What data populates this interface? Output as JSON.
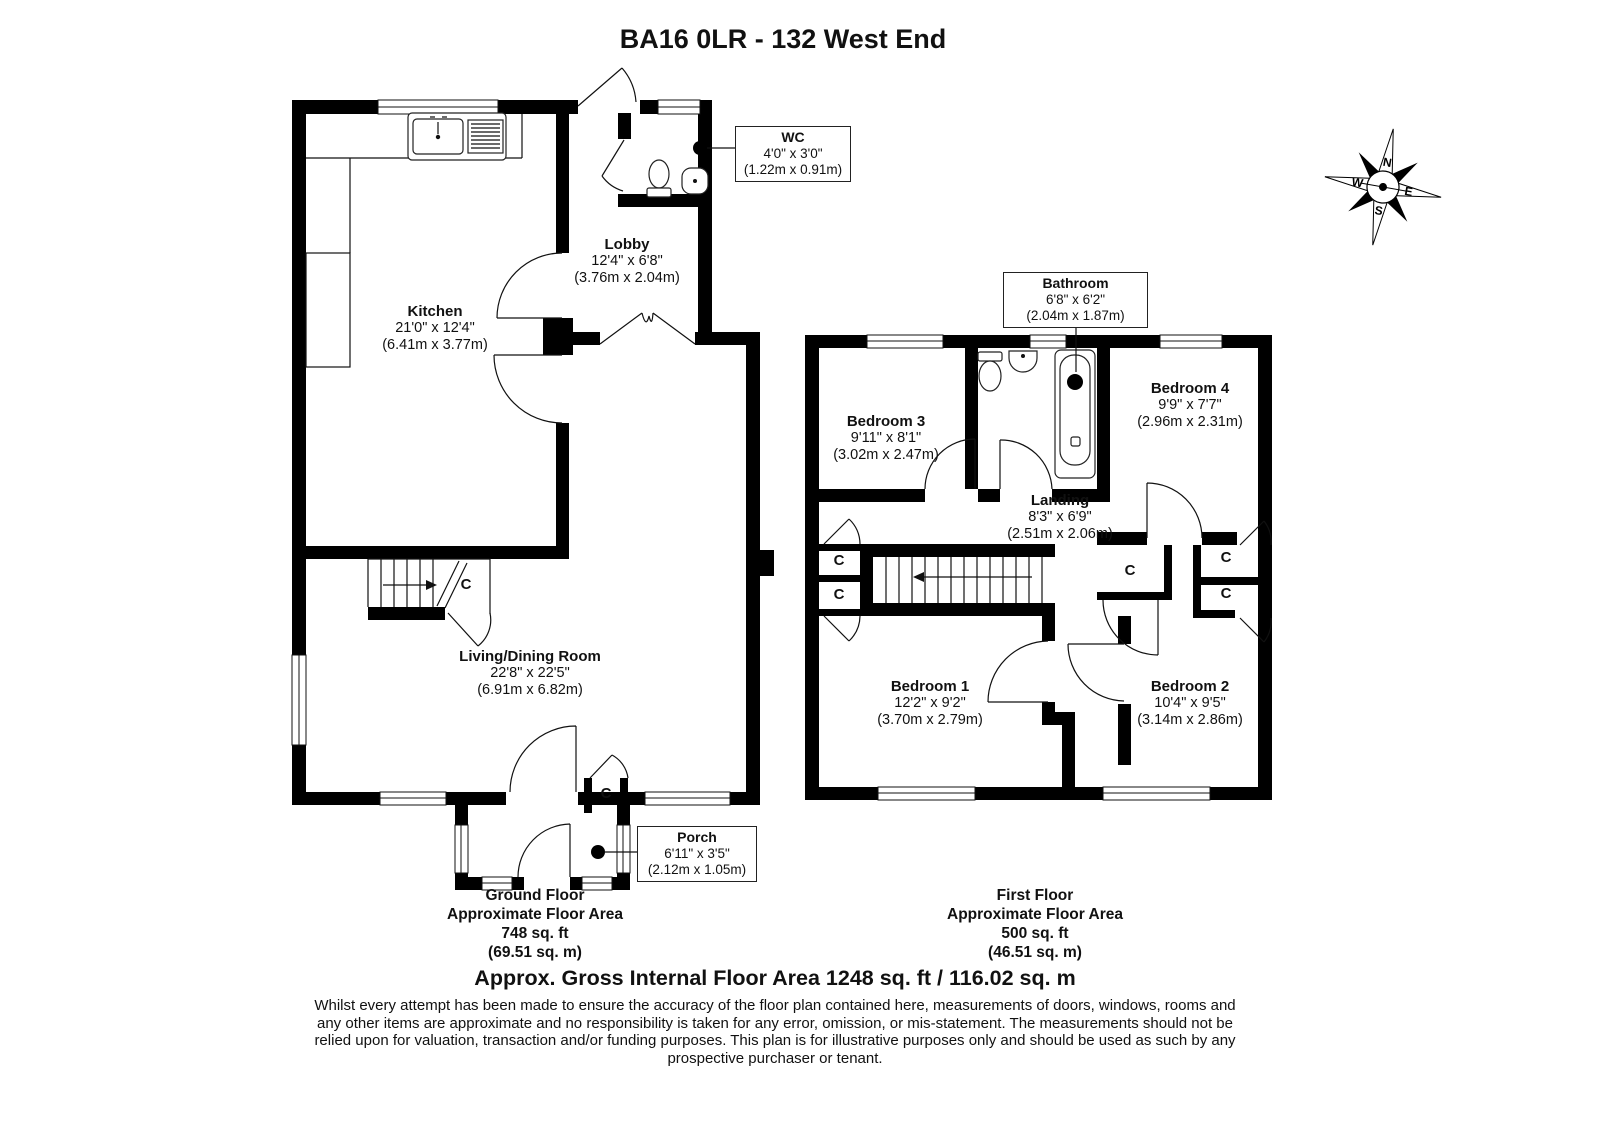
{
  "title": "BA16 0LR - 132 West End",
  "cupboard_label": "C",
  "compass": {
    "north": "N",
    "east": "E",
    "south": "S",
    "west": "W"
  },
  "ground_floor": {
    "rooms": {
      "kitchen": {
        "name": "Kitchen",
        "imperial": "21'0\" x 12'4\"",
        "metric": "(6.41m x 3.77m)"
      },
      "lobby": {
        "name": "Lobby",
        "imperial": "12'4\" x 6'8\"",
        "metric": "(3.76m x 2.04m)"
      },
      "wc": {
        "name": "WC",
        "imperial": "4'0\" x 3'0\"",
        "metric": "(1.22m x 0.91m)"
      },
      "living_dining": {
        "name": "Living/Dining Room",
        "imperial": "22'8\" x 22'5\"",
        "metric": "(6.91m x 6.82m)"
      },
      "porch": {
        "name": "Porch",
        "imperial": "6'11\" x 3'5\"",
        "metric": "(2.12m x 1.05m)"
      }
    },
    "summary": {
      "floor": "Ground Floor",
      "area_label": "Approximate Floor Area",
      "area_ft": "748 sq. ft",
      "area_m": "(69.51 sq. m)"
    }
  },
  "first_floor": {
    "rooms": {
      "bedroom3": {
        "name": "Bedroom 3",
        "imperial": "9'11\" x 8'1\"",
        "metric": "(3.02m x 2.47m)"
      },
      "bathroom": {
        "name": "Bathroom",
        "imperial": "6'8\" x 6'2\"",
        "metric": "(2.04m x 1.87m)"
      },
      "bedroom4": {
        "name": "Bedroom 4",
        "imperial": "9'9\" x 7'7\"",
        "metric": "(2.96m x 2.31m)"
      },
      "landing": {
        "name": "Landing",
        "imperial": "8'3\" x 6'9\"",
        "metric": "(2.51m x 2.06m)"
      },
      "bedroom1": {
        "name": "Bedroom 1",
        "imperial": "12'2\" x 9'2\"",
        "metric": "(3.70m x 2.79m)"
      },
      "bedroom2": {
        "name": "Bedroom 2",
        "imperial": "10'4\" x 9'5\"",
        "metric": "(3.14m x 2.86m)"
      }
    },
    "summary": {
      "floor": "First Floor",
      "area_label": "Approximate Floor Area",
      "area_ft": "500 sq. ft",
      "area_m": "(46.51 sq. m)"
    }
  },
  "footer": {
    "gross_area": "Approx. Gross Internal Floor Area 1248 sq. ft / 116.02 sq. m",
    "disclaimer": "Whilst every attempt has been made to ensure the accuracy of the floor plan contained here, measurements of doors, windows, rooms and any other items are approximate and no responsibility is taken for any error, omission, or mis-statement. The measurements should not be relied upon for valuation, transaction and/or funding purposes. This plan is for illustrative purposes only and should be used as such by any prospective purchaser or tenant."
  }
}
